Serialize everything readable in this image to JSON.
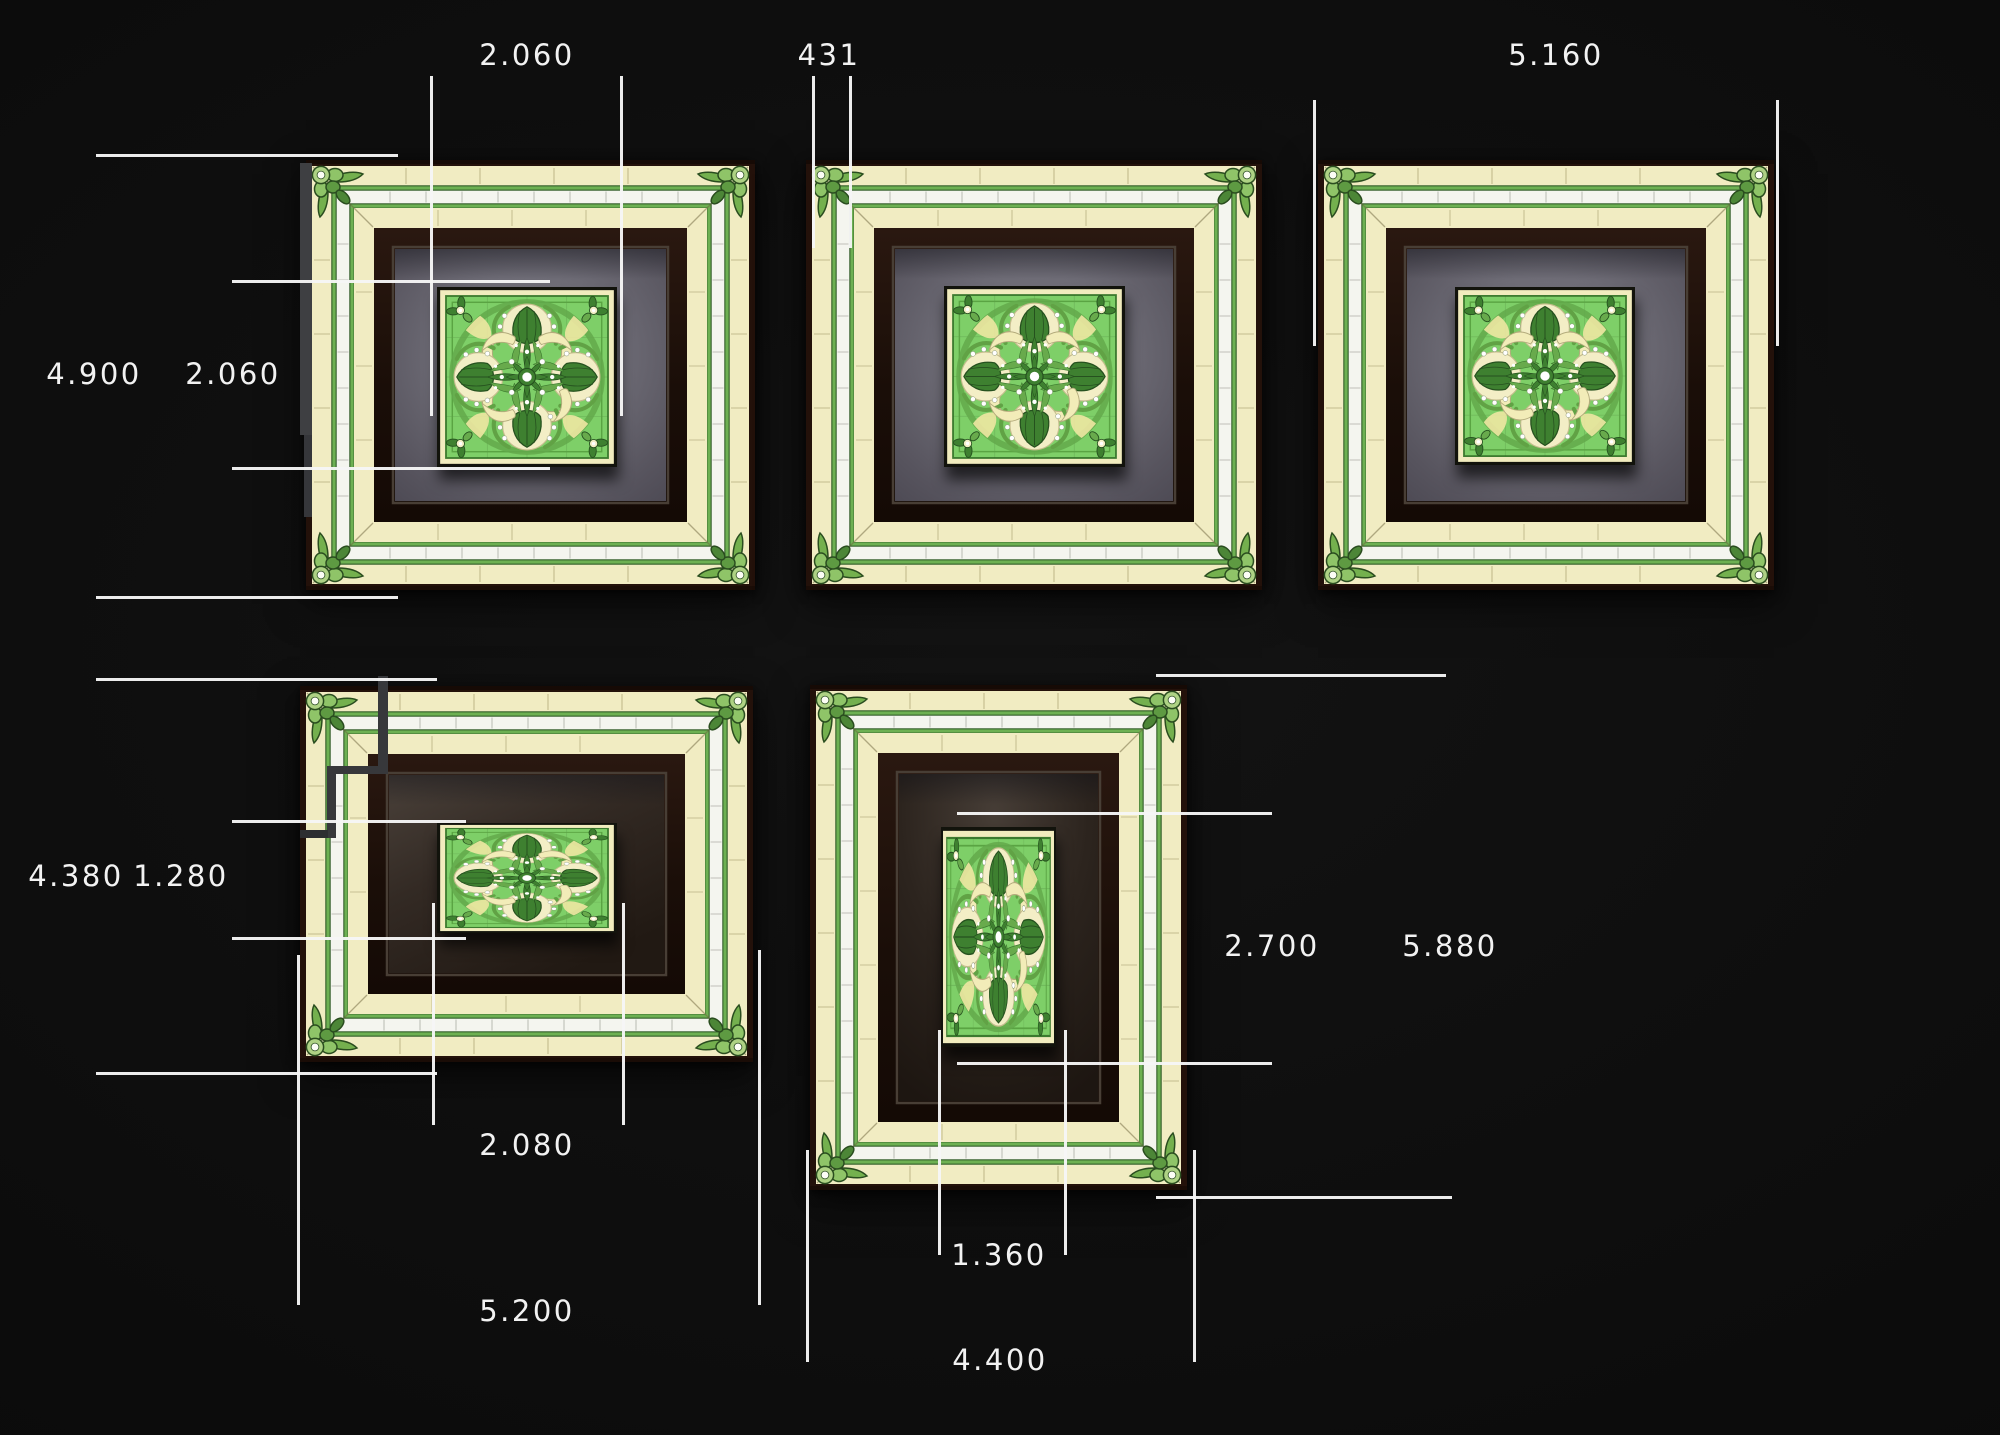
{
  "scene": {
    "type": "ceiling-panel-dimension-drawing",
    "background_color": "#0b0b0b",
    "panel_count": 5,
    "units_shown": "millimeters (plan dimensions)"
  },
  "colors": {
    "dimension_line": "#f2f2f2",
    "label_text": "#f2f2f2",
    "frame_cream": "#f1ecc2",
    "frame_white_band": "#f4f5ef",
    "frame_green_line": "#6db052",
    "ornament_dark_green": "#3e8030",
    "tile_background_green": "#7ecf68",
    "field_gray": "#6d6b75",
    "field_dark_brown": "#2c241e",
    "section_mark_gray": "#37383b"
  },
  "annotations": {
    "top_medallion_width": "2.060",
    "border_width": "431",
    "top_right_panel_width": "5.160",
    "left_panel_height": "4.900",
    "left_medallion_height": "2.060",
    "bottom_left_panel_height": "4.380",
    "bottom_left_medallion_height": "1.280",
    "bottom_center_medallion_height": "2.700",
    "bottom_center_panel_height": "5.880",
    "bottom_left_medallion_width": "2.080",
    "bottom_center_medallion_width": "1.360",
    "bottom_left_panel_width": "5.200",
    "bottom_center_panel_width": "4.400"
  }
}
